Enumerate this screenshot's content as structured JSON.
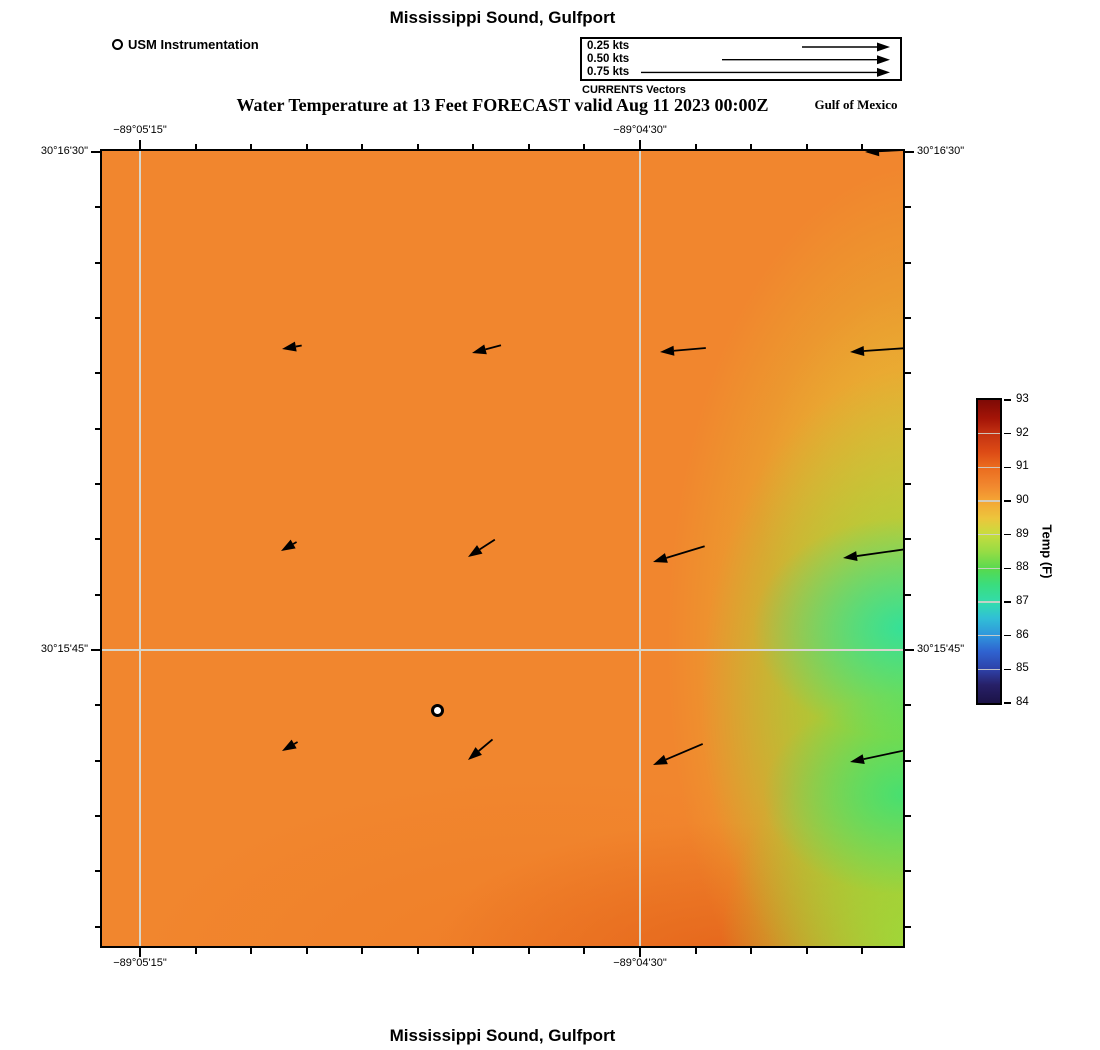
{
  "figure": {
    "top_title": "Mississippi Sound, Gulfport",
    "subtitle": "Water Temperature at 13 Feet FORECAST valid Aug 11 2023 00:00Z",
    "region_label": "Gulf of Mexico",
    "bottom_title": "Mississippi Sound, Gulfport",
    "background": "#ffffff"
  },
  "instrument_legend": {
    "label": "USM Instrumentation"
  },
  "currents_legend": {
    "caption": "CURRENTS Vectors",
    "entries": [
      {
        "label": "0.25 kts",
        "arrow_len": 88
      },
      {
        "label": "0.50 kts",
        "arrow_len": 168
      },
      {
        "label": "0.75 kts",
        "arrow_len": 249
      }
    ]
  },
  "map": {
    "frame": {
      "left": 100,
      "top": 149,
      "width": 805,
      "height": 799
    },
    "grid_color": "#d7d7cd",
    "field_colors": {
      "base_orange": "#F1862E",
      "warm_patch": "#E25F18",
      "yellow_green": "#BADF37",
      "green": "#49E178",
      "teal_green": "#2DE1A0"
    },
    "x_axis": {
      "ticks": [
        40,
        96,
        151,
        207,
        262,
        318,
        373,
        429,
        484,
        540,
        596,
        651,
        707,
        762
      ],
      "major_ticks": [
        40,
        540
      ],
      "labels": [
        {
          "text": "−89°05'15\"",
          "px": 40
        },
        {
          "text": "−89°04'30\"",
          "px": 540
        }
      ]
    },
    "y_axis": {
      "ticks": [
        3,
        58,
        114,
        169,
        224,
        280,
        335,
        390,
        446,
        501,
        556,
        612,
        667,
        722,
        778
      ],
      "major_ticks": [
        3,
        501
      ],
      "labels": [
        {
          "text": "30°16'30\"",
          "px": 3
        },
        {
          "text": "30°15'45\"",
          "px": 501
        }
      ]
    },
    "gridlines": {
      "vertical": [
        40,
        540
      ],
      "horizontal": [
        501
      ]
    },
    "station_marker": {
      "x": 337,
      "y": 561
    },
    "vectors": [
      {
        "x": 765,
        "y": 3,
        "len": 58,
        "ang": 177
      },
      {
        "x": 182,
        "y": 200,
        "len": 20,
        "ang": 170
      },
      {
        "x": 372,
        "y": 204,
        "len": 30,
        "ang": 165
      },
      {
        "x": 560,
        "y": 203,
        "len": 46,
        "ang": 175
      },
      {
        "x": 750,
        "y": 203,
        "len": 60,
        "ang": 176
      },
      {
        "x": 181,
        "y": 402,
        "len": 18,
        "ang": 150
      },
      {
        "x": 368,
        "y": 408,
        "len": 32,
        "ang": 147
      },
      {
        "x": 553,
        "y": 413,
        "len": 54,
        "ang": 163
      },
      {
        "x": 743,
        "y": 409,
        "len": 64,
        "ang": 172
      },
      {
        "x": 182,
        "y": 602,
        "len": 18,
        "ang": 150
      },
      {
        "x": 368,
        "y": 611,
        "len": 32,
        "ang": 140
      },
      {
        "x": 553,
        "y": 616,
        "len": 54,
        "ang": 157
      },
      {
        "x": 750,
        "y": 613,
        "len": 60,
        "ang": 168
      }
    ]
  },
  "colorbar": {
    "title": "Temp (F)",
    "min": 84,
    "max": 93,
    "ticks": [
      93,
      92,
      91,
      90,
      89,
      88,
      87,
      86,
      85,
      84
    ],
    "frame": {
      "left": 978,
      "top": 400,
      "width": 22,
      "height": 303
    },
    "gradient_stops": [
      {
        "pos": 0,
        "color": "#7E0A06"
      },
      {
        "pos": 6,
        "color": "#A31407"
      },
      {
        "pos": 11,
        "color": "#C33212"
      },
      {
        "pos": 17,
        "color": "#DC4A15"
      },
      {
        "pos": 22,
        "color": "#EA6A1E"
      },
      {
        "pos": 28,
        "color": "#F1862E"
      },
      {
        "pos": 33,
        "color": "#F4A434"
      },
      {
        "pos": 39,
        "color": "#EDC53C"
      },
      {
        "pos": 44,
        "color": "#C9DC3E"
      },
      {
        "pos": 50,
        "color": "#97DC44"
      },
      {
        "pos": 56,
        "color": "#55DA50"
      },
      {
        "pos": 61,
        "color": "#3ADD7E"
      },
      {
        "pos": 67,
        "color": "#32DCAE"
      },
      {
        "pos": 72,
        "color": "#31BFD6"
      },
      {
        "pos": 78,
        "color": "#2F93DC"
      },
      {
        "pos": 83,
        "color": "#2F63D0"
      },
      {
        "pos": 89,
        "color": "#2E41A8"
      },
      {
        "pos": 94,
        "color": "#272068"
      },
      {
        "pos": 100,
        "color": "#1C1347"
      }
    ]
  },
  "chart_data": {
    "type": "heatmap",
    "title": "Mississippi Sound, Gulfport",
    "subtitle": "Water Temperature at 13 Feet FORECAST valid Aug 11 2023 00:00Z",
    "footer_title": "Mississippi Sound, Gulfport",
    "colorbar": {
      "label": "Temp (F)",
      "range": [
        84,
        93
      ],
      "ticks": [
        84,
        85,
        86,
        87,
        88,
        89,
        90,
        91,
        92,
        93
      ]
    },
    "x_axis_ticks_labeled": [
      "−89°05'15\"",
      "−89°04'30\""
    ],
    "y_axis_ticks_labeled": [
      "30°16'30\"",
      "30°15'45\""
    ],
    "field_description": "Water temperature mostly 90–91 °F (orange) across the sound; cooler 87–89 °F band (green) along the eastern edge centered near 30°15'45\"; slightly warmer ~91.5 °F patch near the south-central bottom edge.",
    "vector_legend_speeds_kts": [
      0.25,
      0.5,
      0.75
    ],
    "vector_description": "Current vectors in a 4×3 grid plus one at the NE corner, all pointing west/southwest; magnitudes increase eastward from ~0.2 kts to ~0.6 kts.",
    "station": {
      "name": "USM Instrumentation",
      "marker": "open circle",
      "region_label": "Gulf of Mexico"
    }
  }
}
